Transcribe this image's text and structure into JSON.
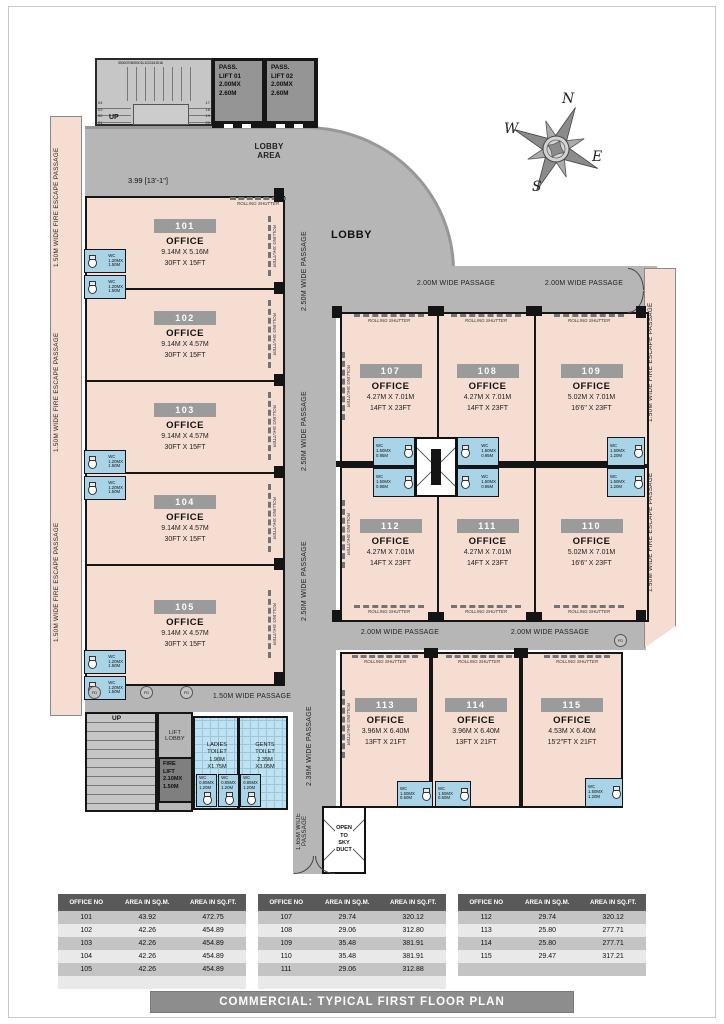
{
  "page": {
    "title": "COMMERCIAL: TYPICAL FIRST FLOOR PLAN"
  },
  "compass": {
    "n": "N",
    "e": "E",
    "s": "S",
    "w": "W"
  },
  "stairs": {
    "top_numbers": "05 06 07 08 09 10 11 12 13 14 15 16",
    "left_numbers": "04\n03\n02\n01",
    "right_numbers": "17\n18\n19\n20"
  },
  "lifts": {
    "pass1": "PASS.\nLIFT 01\n2.00MX\n2.60M",
    "pass2": "PASS.\nLIFT 02\n2.00MX\n2.60M",
    "fire": "FIRE\nLIFT\n2.10MX\n1.50M",
    "lift_lobby": "LIFT\nLOBBY"
  },
  "labels": {
    "lobby": "LOBBY",
    "lobby_area": "LOBBY\nAREA",
    "up": "UP",
    "fire_escape": "1.50M WIDE FIRE ESCAPE PASSAGE",
    "p250": "2.50M WIDE PASSAGE",
    "p239": "2.39M WIDE PASSAGE",
    "p200": "2.00M WIDE PASSAGE",
    "p150": "1.50M WIDE PASSAGE",
    "p165": "1.65M WIDE PASSAGE",
    "rolling_shutter": "ROLLING SHUTTER",
    "open_sky": "OPEN\nTO\nSKY\nDUCT",
    "fd": "FD",
    "dim_w": "3.99 [13'-1\"]",
    "dim_h": "3.24 [10'-8\"]"
  },
  "toilets": {
    "ladies": "LADIES\nTOILET\n1.90M\nX1.75M",
    "gents": "GENTS\nTOILET\n2.35M\nX3.05M",
    "wc_left": "WC\n1.20MX\n1.50M",
    "wc_core": "WC\n1.50MX\n0.95M",
    "wc_right": "WC\n1.50MX\n1.20M",
    "wc_row3": "WC\n1.50MX\n0.60M",
    "wc_stall": "WC\n0.85MX\n1.20M"
  },
  "offices": [
    {
      "no": "101",
      "type": "OFFICE",
      "dim_m": "9.14M X 5.16M",
      "dim_ft": "30FT X 15FT"
    },
    {
      "no": "102",
      "type": "OFFICE",
      "dim_m": "9.14M X 4.57M",
      "dim_ft": "30FT X 15FT"
    },
    {
      "no": "103",
      "type": "OFFICE",
      "dim_m": "9.14M X 4.57M",
      "dim_ft": "30FT X 15FT"
    },
    {
      "no": "104",
      "type": "OFFICE",
      "dim_m": "9.14M X 4.57M",
      "dim_ft": "30FT X 15FT"
    },
    {
      "no": "105",
      "type": "OFFICE",
      "dim_m": "9.14M X 4.57M",
      "dim_ft": "30FT X 15FT"
    },
    {
      "no": "107",
      "type": "OFFICE",
      "dim_m": "4.27M X 7.01M",
      "dim_ft": "14FT X 23FT"
    },
    {
      "no": "108",
      "type": "OFFICE",
      "dim_m": "4.27M X 7.01M",
      "dim_ft": "14FT X 23FT"
    },
    {
      "no": "109",
      "type": "OFFICE",
      "dim_m": "5.02M X 7.01M",
      "dim_ft": "16'6\" X 23FT"
    },
    {
      "no": "112",
      "type": "OFFICE",
      "dim_m": "4.27M X 7.01M",
      "dim_ft": "14FT X 23FT"
    },
    {
      "no": "111",
      "type": "OFFICE",
      "dim_m": "4.27M X 7.01M",
      "dim_ft": "14FT X 23FT"
    },
    {
      "no": "110",
      "type": "OFFICE",
      "dim_m": "5.02M X 7.01M",
      "dim_ft": "16'6\" X 23FT"
    },
    {
      "no": "113",
      "type": "OFFICE",
      "dim_m": "3.96M X 6.40M",
      "dim_ft": "13FT X 21FT"
    },
    {
      "no": "114",
      "type": "OFFICE",
      "dim_m": "3.96M X 6.40M",
      "dim_ft": "13FT X 21FT"
    },
    {
      "no": "115",
      "type": "OFFICE",
      "dim_m": "4.53M X 6.40M",
      "dim_ft": "15'2\"FT X 21FT"
    }
  ],
  "tables": [
    {
      "headers": [
        "OFFICE NO",
        "AREA IN SQ.M.",
        "AREA IN SQ.FT."
      ],
      "rows": [
        [
          "101",
          "43.92",
          "472.75"
        ],
        [
          "102",
          "42.26",
          "454.89"
        ],
        [
          "103",
          "42.26",
          "454.89"
        ],
        [
          "104",
          "42.26",
          "454.89"
        ],
        [
          "105",
          "42.26",
          "454.89"
        ]
      ]
    },
    {
      "headers": [
        "OFFICE NO",
        "AREA IN SQ.M.",
        "AREA IN SQ.FT."
      ],
      "rows": [
        [
          "107",
          "29.74",
          "320.12"
        ],
        [
          "108",
          "29.06",
          "312.80"
        ],
        [
          "109",
          "35.48",
          "381.91"
        ],
        [
          "110",
          "35.48",
          "381.91"
        ],
        [
          "111",
          "29.06",
          "312.88"
        ]
      ]
    },
    {
      "headers": [
        "OFFICE NO",
        "AREA IN SQ.M.",
        "AREA IN SQ.FT."
      ],
      "rows": [
        [
          "112",
          "29.74",
          "320.12"
        ],
        [
          "113",
          "25.80",
          "277.71"
        ],
        [
          "114",
          "25.80",
          "277.71"
        ],
        [
          "115",
          "29.47",
          "317.21"
        ],
        [
          "",
          "",
          ""
        ]
      ]
    }
  ]
}
